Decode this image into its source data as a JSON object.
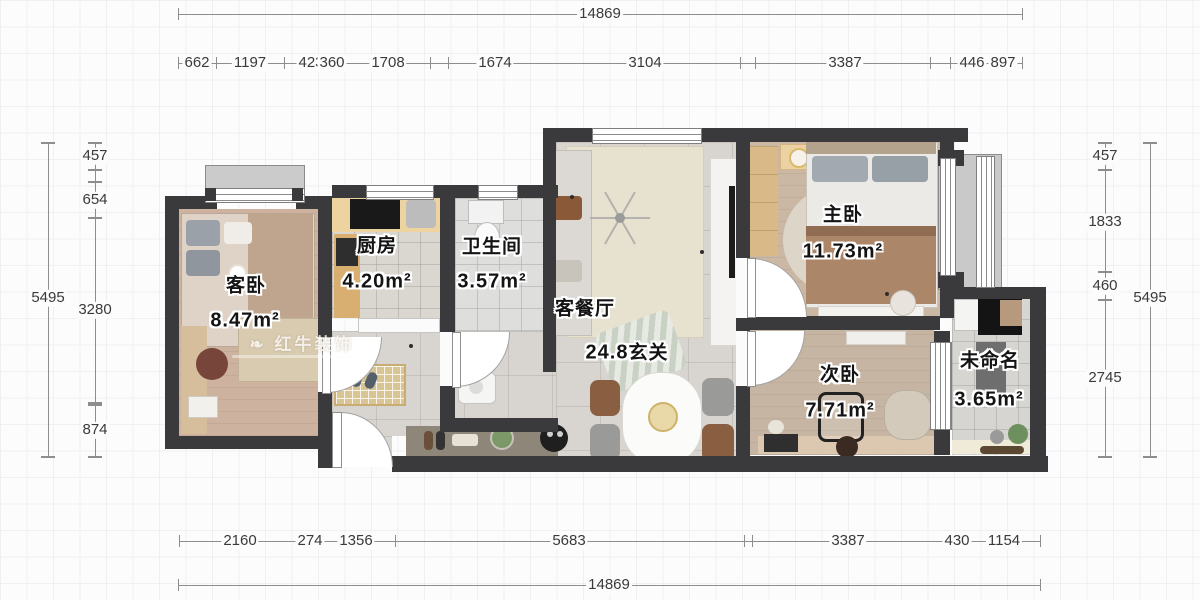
{
  "plan": {
    "watermark": "红牛装饰",
    "rooms": [
      {
        "name": "客卧",
        "area": "8.47m²"
      },
      {
        "name": "厨房",
        "area": "4.20m²"
      },
      {
        "name": "卫生间",
        "area": "3.57m²"
      },
      {
        "name": "客餐厅",
        "area": "24.8",
        "tag": "玄关"
      },
      {
        "name": "主卧",
        "area": "11.73m²"
      },
      {
        "name": "次卧",
        "area": "7.71m²"
      },
      {
        "name": "未命名",
        "area": "3.65m²"
      }
    ]
  },
  "dims": {
    "top_total": "14869",
    "bottom_total": "14869",
    "left_outer": "5495",
    "right_outer": "5495",
    "top_chain": [
      "662",
      "1197",
      "423",
      "360",
      "1708",
      "1674",
      "3104",
      "3387",
      "446",
      "897"
    ],
    "left_chain": [
      "457",
      "654",
      "3280",
      "874"
    ],
    "right_chain": [
      "457",
      "1833",
      "460",
      "2745"
    ],
    "bottom_chain": [
      "2160",
      "274",
      "1356",
      "5683",
      "3387",
      "430",
      "1154"
    ]
  },
  "colors": {
    "wall": "#3a3a3c",
    "wood_floor": "#cdb39f",
    "tile_floor": "#d8d5d1",
    "dim_line": "#8d8d8d",
    "label_text": "#141414",
    "label_halo": "#ffffff"
  }
}
